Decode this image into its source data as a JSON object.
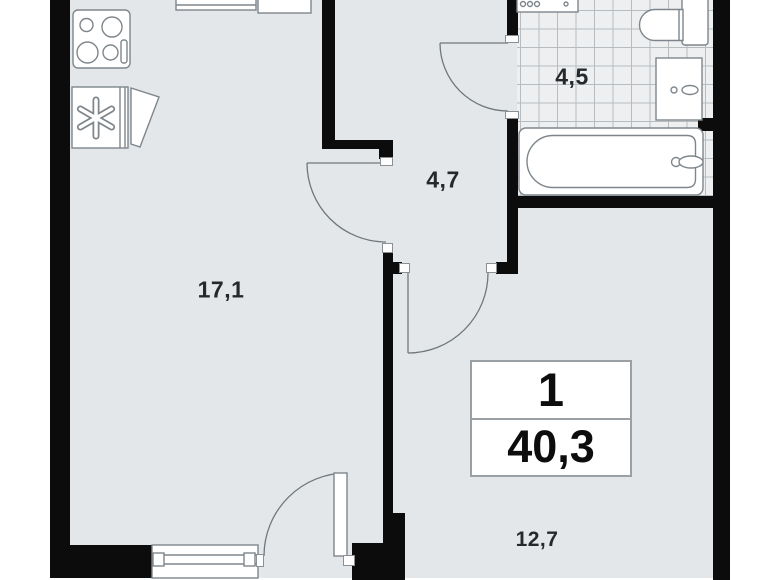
{
  "floorplan": {
    "summary": {
      "room_count": "1",
      "total_area": "40,3"
    },
    "areas": {
      "living_kitchen": "17,1",
      "hallway": "4,7",
      "bathroom": "4,5",
      "bedroom": "12,7"
    },
    "colors": {
      "wall": "#0c0c0c",
      "floor": "#e4e7e9",
      "tile_floor": "#edeff1",
      "tile_line": "#b7bcc0",
      "fixture_stroke": "#7e868b",
      "label_text": "#26292c",
      "background": "#ffffff"
    }
  }
}
